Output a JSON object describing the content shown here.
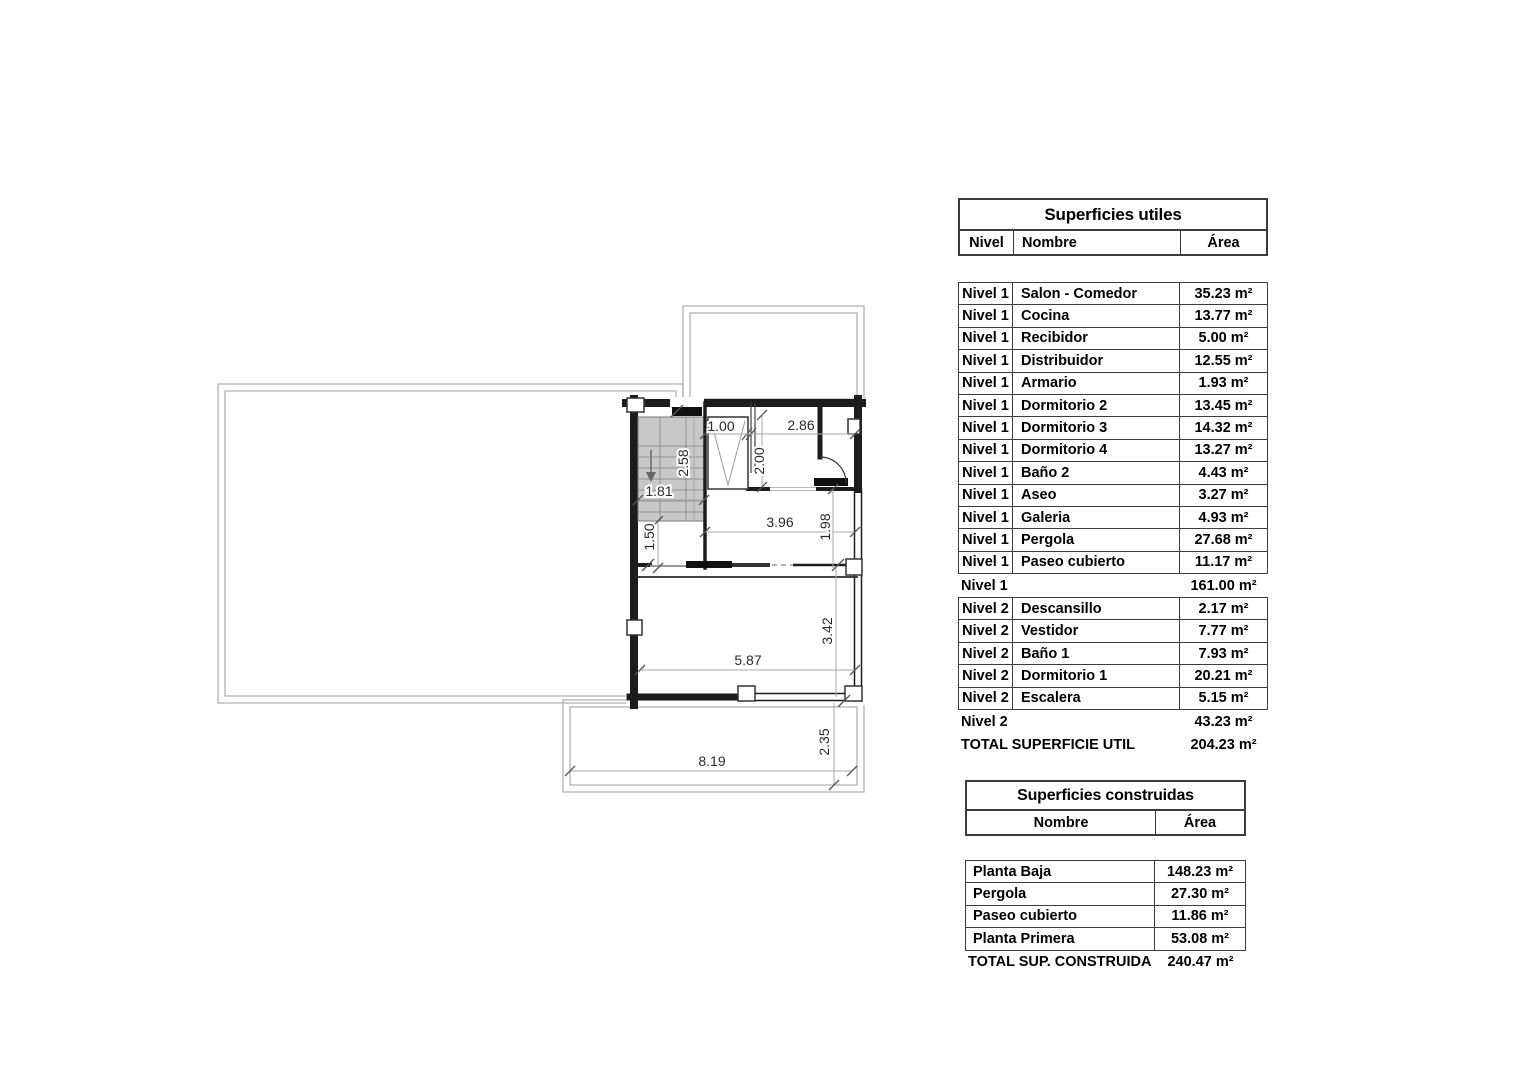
{
  "plan": {
    "dimensions": {
      "closet_width": "1.00",
      "hall_width": "2.86",
      "hall_depth": "2.00",
      "stair_length": "2.58",
      "stair_width": "1.81",
      "distribuidor_width": "3.96",
      "distribuidor_depth": "1.98",
      "corridor_width": "1.50",
      "salon_depth": "3.42",
      "salon_width": "5.87",
      "terrace_depth": "2.35",
      "terrace_width": "8.19"
    }
  },
  "tables": {
    "utiles": {
      "title": "Superficies utiles",
      "headers": {
        "nivel": "Nivel",
        "nombre": "Nombre",
        "area": "Área"
      },
      "nivel1_rows": [
        {
          "nivel": "Nivel 1",
          "nombre": "Salon - Comedor",
          "area": "35.23 m²"
        },
        {
          "nivel": "Nivel 1",
          "nombre": "Cocina",
          "area": "13.77 m²"
        },
        {
          "nivel": "Nivel 1",
          "nombre": "Recibidor",
          "area": "5.00 m²"
        },
        {
          "nivel": "Nivel 1",
          "nombre": "Distribuidor",
          "area": "12.55 m²"
        },
        {
          "nivel": "Nivel 1",
          "nombre": "Armario",
          "area": "1.93 m²"
        },
        {
          "nivel": "Nivel 1",
          "nombre": "Dormitorio 2",
          "area": "13.45 m²"
        },
        {
          "nivel": "Nivel 1",
          "nombre": "Dormitorio 3",
          "area": "14.32 m²"
        },
        {
          "nivel": "Nivel 1",
          "nombre": "Dormitorio 4",
          "area": "13.27 m²"
        },
        {
          "nivel": "Nivel 1",
          "nombre": "Baño 2",
          "area": "4.43 m²"
        },
        {
          "nivel": "Nivel 1",
          "nombre": "Aseo",
          "area": "3.27 m²"
        },
        {
          "nivel": "Nivel 1",
          "nombre": "Galeria",
          "area": "4.93 m²"
        },
        {
          "nivel": "Nivel 1",
          "nombre": "Pergola",
          "area": "27.68 m²"
        },
        {
          "nivel": "Nivel 1",
          "nombre": "Paseo cubierto",
          "area": "11.17 m²"
        }
      ],
      "nivel1_subtotal": {
        "label": "Nivel 1",
        "area": "161.00 m²"
      },
      "nivel2_rows": [
        {
          "nivel": "Nivel 2",
          "nombre": "Descansillo",
          "area": "2.17 m²"
        },
        {
          "nivel": "Nivel 2",
          "nombre": "Vestidor",
          "area": "7.77 m²"
        },
        {
          "nivel": "Nivel 2",
          "nombre": "Baño 1",
          "area": "7.93 m²"
        },
        {
          "nivel": "Nivel 2",
          "nombre": "Dormitorio 1",
          "area": "20.21 m²"
        },
        {
          "nivel": "Nivel 2",
          "nombre": "Escalera",
          "area": "5.15 m²"
        }
      ],
      "nivel2_subtotal": {
        "label": "Nivel 2",
        "area": "43.23 m²"
      },
      "total": {
        "label": "TOTAL SUPERFICIE UTIL",
        "area": "204.23 m²"
      }
    },
    "construidas": {
      "title": "Superficies construidas",
      "headers": {
        "nombre": "Nombre",
        "area": "Área"
      },
      "rows": [
        {
          "nombre": "Planta Baja",
          "area": "148.23 m²"
        },
        {
          "nombre": "Pergola",
          "area": "27.30 m²"
        },
        {
          "nombre": "Paseo cubierto",
          "area": "11.86 m²"
        },
        {
          "nombre": "Planta Primera",
          "area": "53.08 m²"
        }
      ],
      "total": {
        "label": "TOTAL SUP. CONSTRUIDA",
        "area": "240.47 m²"
      }
    }
  }
}
